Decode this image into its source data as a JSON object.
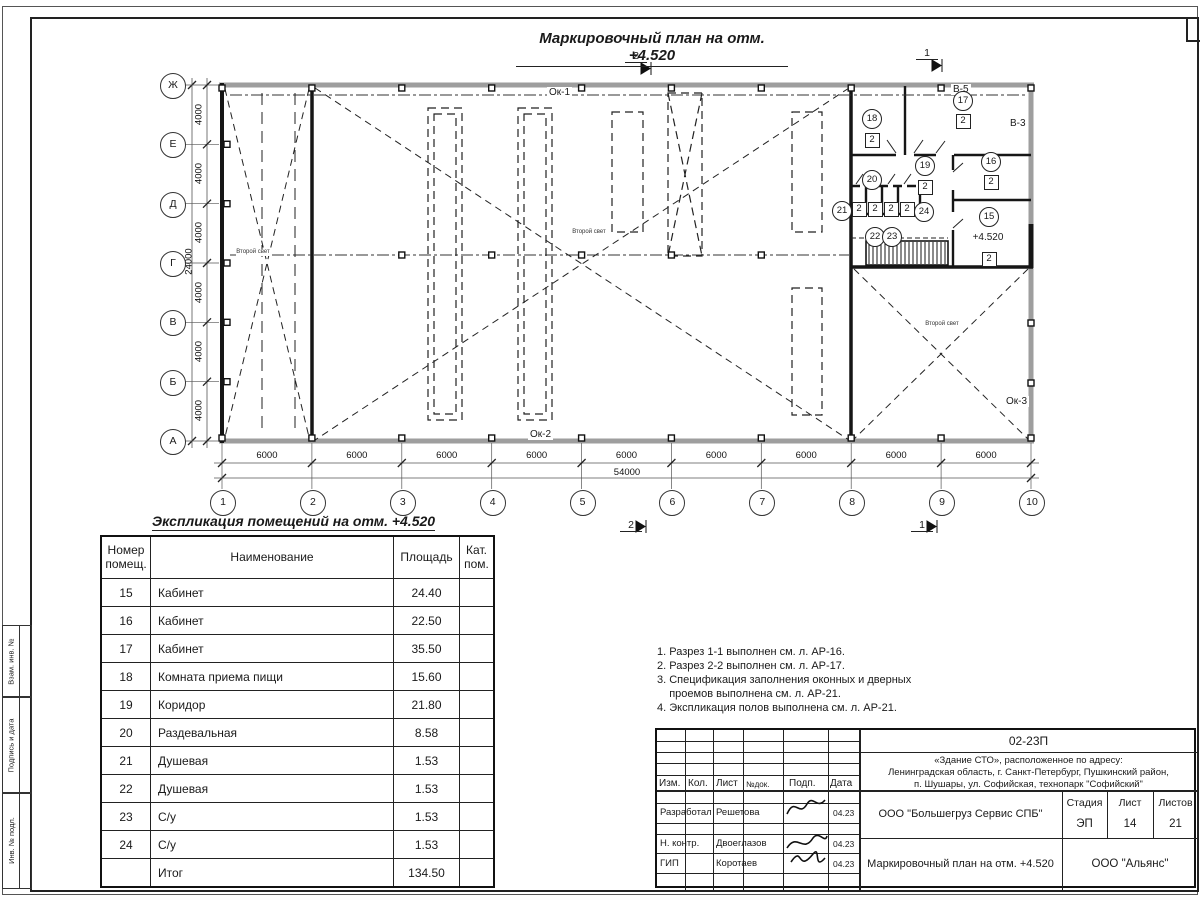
{
  "page": {
    "plan_title": "Маркировочный план на отм. +4.520"
  },
  "plan": {
    "grid_cols": [
      "1",
      "2",
      "3",
      "4",
      "5",
      "6",
      "7",
      "8",
      "9",
      "10"
    ],
    "grid_rows": [
      "Ж",
      "Е",
      "Д",
      "Г",
      "В",
      "Б",
      "А"
    ],
    "dim_h": [
      "6000",
      "6000",
      "6000",
      "6000",
      "6000",
      "6000",
      "6000",
      "6000",
      "6000"
    ],
    "dim_h_total": "54000",
    "dim_v": [
      "4000",
      "4000",
      "4000",
      "4000",
      "4000",
      "4000"
    ],
    "dim_v_total": "24000",
    "labels": {
      "ok1": "Ок-1",
      "ok2": "Ок-2",
      "ok3": "Ок-3",
      "b5": "В-5",
      "b3": "В-3",
      "second_light": "Второй свет",
      "level": "+4.520",
      "sec1": "1",
      "sec2": "2"
    },
    "rooms": [
      {
        "num": "15",
        "cat": "2"
      },
      {
        "num": "16",
        "cat": "2"
      },
      {
        "num": "17",
        "cat": "2"
      },
      {
        "num": "18",
        "cat": "2"
      },
      {
        "num": "19",
        "cat": "2"
      },
      {
        "num": "20",
        "cat": ""
      },
      {
        "num": "21",
        "cat": "2"
      },
      {
        "num": "22",
        "cat": "2"
      },
      {
        "num": "23",
        "cat": "2"
      },
      {
        "num": "24",
        "cat": "2"
      }
    ]
  },
  "table": {
    "title": "Экспликация помещений на отм. +4.520",
    "headers": [
      "Номер помещ.",
      "Наименование",
      "Площадь",
      "Кат. пом."
    ],
    "rows": [
      [
        "15",
        "Кабинет",
        "24.40",
        ""
      ],
      [
        "16",
        "Кабинет",
        "22.50",
        ""
      ],
      [
        "17",
        "Кабинет",
        "35.50",
        ""
      ],
      [
        "18",
        "Комната приема пищи",
        "15.60",
        ""
      ],
      [
        "19",
        "Коридор",
        "21.80",
        ""
      ],
      [
        "20",
        "Раздевальная",
        "8.58",
        ""
      ],
      [
        "21",
        "Душевая",
        "1.53",
        ""
      ],
      [
        "22",
        "Душевая",
        "1.53",
        ""
      ],
      [
        "23",
        "С/у",
        "1.53",
        ""
      ],
      [
        "24",
        "С/у",
        "1.53",
        ""
      ],
      [
        "",
        "Итог",
        "134.50",
        ""
      ]
    ]
  },
  "notes": [
    "1. Разрез 1-1 выполнен см. л. АР-16.",
    "2. Разрез 2-2 выполнен см. л. АР-17.",
    "3. Спецификация заполнения оконных и дверных",
    "    проемов выполнена см. л. АР-21.",
    "4. Экспликация полов выполнена см. л. АР-21."
  ],
  "titleblock": {
    "doc_number": "02-23П",
    "address_lines": [
      "«Здание СТО», расположенное по адресу:",
      "Ленинградская область, г. Санкт-Петербург, Пушкинский район,",
      "п. Шушары, ул. Софийская, технопарк \"Софийский\""
    ],
    "header_cols": [
      "Изм.",
      "Кол.",
      "Лист",
      "№док.",
      "Подп.",
      "Дата"
    ],
    "roles": [
      {
        "role": "Разработал",
        "name": "Решетова",
        "date": "04.23"
      },
      {
        "role": "Н. контр.",
        "name": "Двоеглазов",
        "date": "04.23"
      },
      {
        "role": "ГИП",
        "name": "Коротаев",
        "date": "04.23"
      }
    ],
    "org": "ООО \"Большегруз Сервис СПБ\"",
    "stage_label": "Стадия",
    "sheet_label": "Лист",
    "sheets_label": "Листов",
    "stage": "ЭП",
    "sheet": "14",
    "sheets": "21",
    "drawing_title": "Маркировочный план на отм. +4.520",
    "company": "ООО \"Альянс\""
  },
  "side_stamp": [
    "Взам. инв. №",
    "Подпись и дата",
    "Инв. № подл."
  ]
}
